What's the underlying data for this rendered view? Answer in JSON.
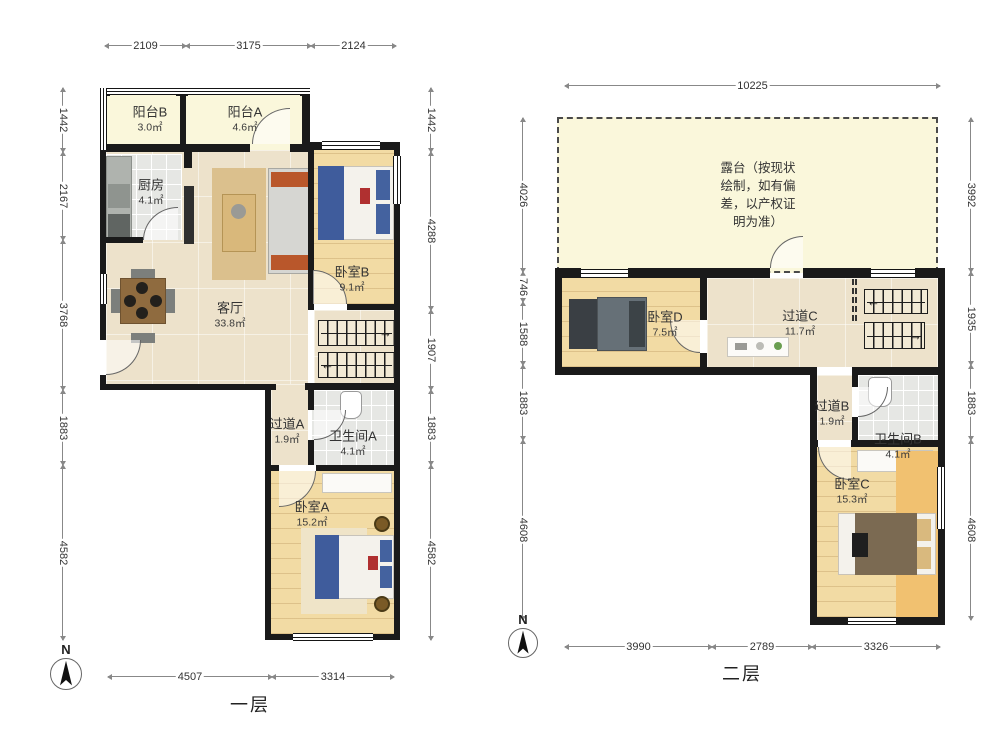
{
  "floor1": {
    "caption": "一层",
    "compass_n": "N",
    "rooms": [
      {
        "name": "阳台B",
        "area": "3.0㎡"
      },
      {
        "name": "阳台A",
        "area": "4.6㎡"
      },
      {
        "name": "厨房",
        "area": "4.1㎡"
      },
      {
        "name": "客厅",
        "area": "33.8㎡"
      },
      {
        "name": "卧室B",
        "area": "9.1㎡"
      },
      {
        "name": "过道A",
        "area": "1.9㎡"
      },
      {
        "name": "卫生间A",
        "area": "4.1㎡"
      },
      {
        "name": "卧室A",
        "area": "15.2㎡"
      }
    ],
    "dims_top": [
      "2109",
      "3175",
      "2124"
    ],
    "dims_left": [
      "1442",
      "2167",
      "3768",
      "1883",
      "4582"
    ],
    "dims_right": [
      "1442",
      "4288",
      "1907",
      "1883",
      "4582"
    ],
    "dims_bottom": [
      "4507",
      "3314"
    ],
    "stair_upper_arrow": "→",
    "stair_lower_arrow": "←"
  },
  "floor2": {
    "caption": "二层",
    "compass_n": "N",
    "terrace_note": "露台（按现状\n绘制，如有偏\n差，以产权证\n明为准）",
    "rooms": [
      {
        "name": "卧室D",
        "area": "7.5㎡"
      },
      {
        "name": "过道C",
        "area": "11.7㎡"
      },
      {
        "name": "过道B",
        "area": "1.9㎡"
      },
      {
        "name": "卫生间B",
        "area": "4.1㎡"
      },
      {
        "name": "卧室C",
        "area": "15.3㎡"
      }
    ],
    "dims_top": [
      "10225"
    ],
    "dims_left": [
      "4026",
      "746",
      "1588",
      "1883",
      "4608"
    ],
    "dims_right": [
      "3992",
      "1935",
      "1883",
      "4608"
    ],
    "dims_bottom": [
      "3990",
      "2789",
      "3326"
    ],
    "stair_upper_arrow": "←",
    "stair_lower_arrow": "→"
  },
  "palette": {
    "wall": "#1a1a1a",
    "balcony_floor": "#FAF7DB",
    "marble_floor": "#EDE2CB",
    "wood_floor": "#F2DBA4",
    "tile_floor": "#E6E7E4",
    "bedroom_c_rug": "#F1C170",
    "dim_line": "#888888"
  }
}
